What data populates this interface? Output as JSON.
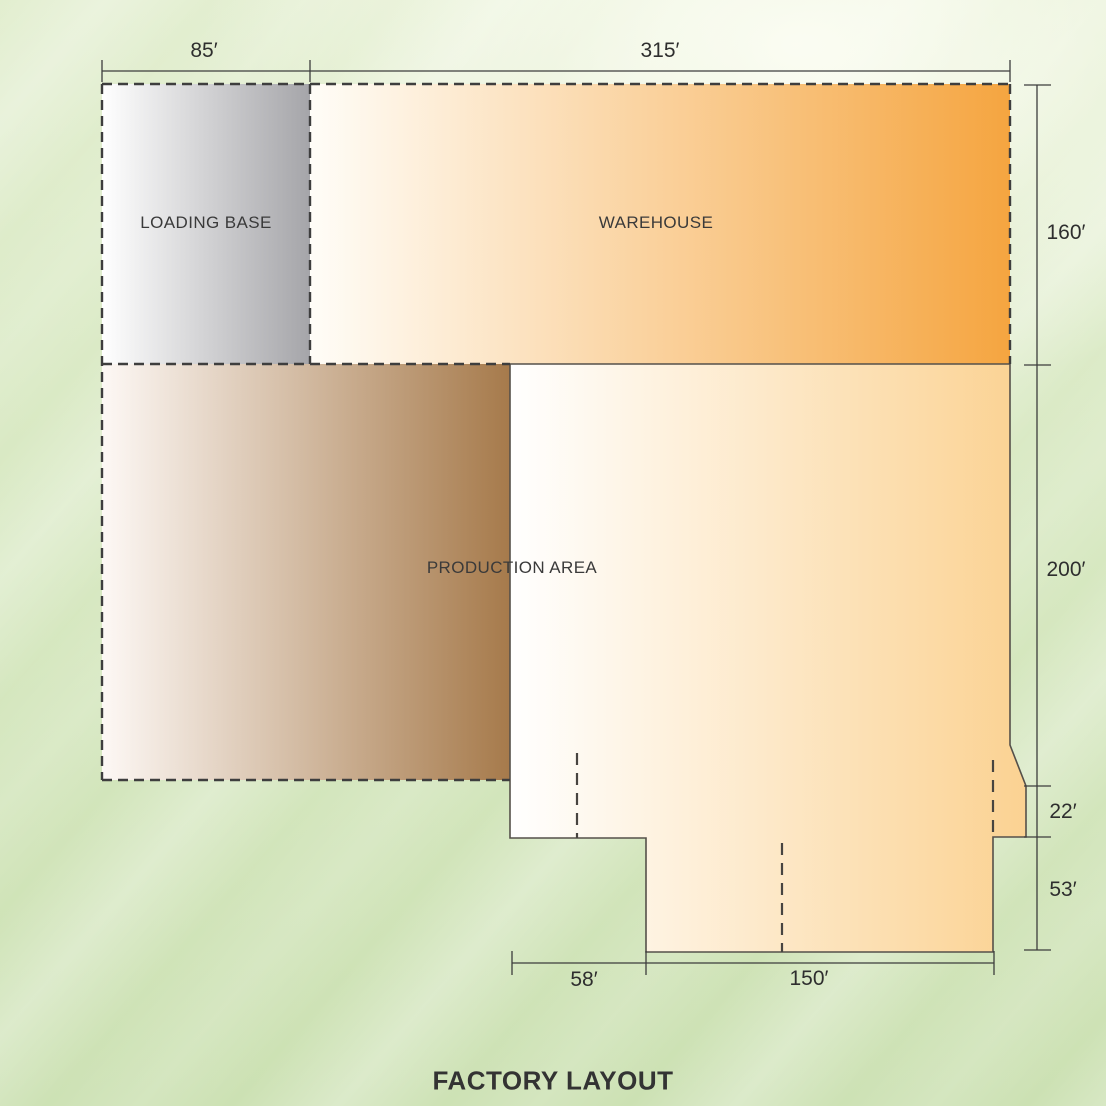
{
  "title": "FACTORY LAYOUT",
  "areas": {
    "loading_base": {
      "label": "LOADING BASE"
    },
    "warehouse": {
      "label": "WAREHOUSE"
    },
    "production": {
      "label": "PRODUCTION AREA"
    }
  },
  "dimensions": {
    "loading_base_width": "85′",
    "warehouse_width": "315′",
    "warehouse_height": "160′",
    "production_height": "200′",
    "notch_height": "22′",
    "bay_height": "53′",
    "bay_offset_width": "58′",
    "bay_width": "150′"
  },
  "colors": {
    "background_green": "#d7e8c1",
    "loading_base_gray": "#a5a5a9",
    "warehouse_orange": "#f5a540",
    "production_brown": "#a67a4b",
    "production_cream": "#fbd292",
    "outline": "#3e3e3e",
    "dimension_line": "#3c3c3c"
  }
}
